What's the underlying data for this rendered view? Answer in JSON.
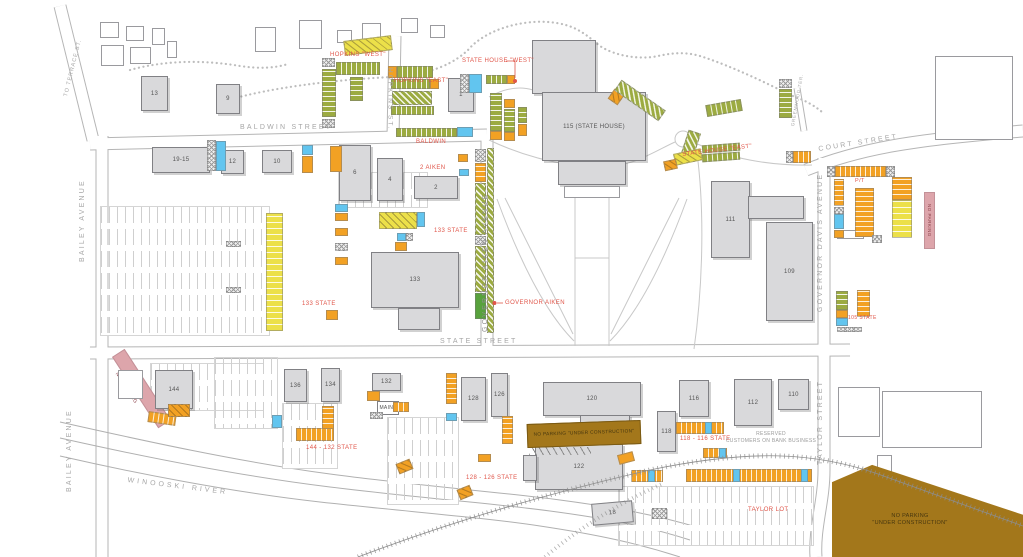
{
  "streets": {
    "to_terrace": "TO TERRACE ST.",
    "hopkins": "HOPKINS ST.",
    "baldwin": "BALDWIN STREET",
    "bailey_upper": "BAILEY AVENUE",
    "bailey_lower": "BAILEY AVENUE",
    "governor_aiken": "GOVERNOR AIKEN AVENUE",
    "state": "STATE STREET",
    "court": "COURT STREET",
    "greenwood": "GREENWOOD TER.",
    "governor_davis": "GOVERNOR DAVIS AVENUE",
    "taylor": "TAYLOR STREET",
    "river": "WINOOSKI RIVER"
  },
  "lot_labels": {
    "hopkins_west": "HOPKINS \"WEST\"",
    "hopkins_east": "HOPKINS \"EAST\"",
    "baldwin": "BALDWIN",
    "state_house_west": "STATE HOUSE \"WEST\"",
    "state_house_east": "STATE HOUSE \"EAST\"",
    "aiken_2": "2 AIKEN",
    "state_133_upper": "133 STATE",
    "state_133_lower": "133 STATE",
    "governor_aiken": "GOVERNOR AIKEN",
    "pt": "P/T",
    "state_105": "105 STATE",
    "state_144_132": "144 - 132 STATE",
    "state_128_126": "128 - 126 STATE",
    "state_118_116": "118 - 116 STATE",
    "taylor_lot": "TAYLOR LOT"
  },
  "zones": {
    "no_parking_bailey": "NO PARKING",
    "no_parking_court": "NO PARKING",
    "construction_strip": "NO PARKING \"UNDER CONSTRUCTION\"",
    "construction_lot_line1": "NO PARKING",
    "construction_lot_line2": "\"UNDER CONSTRUCTION\"",
    "reserved_line1": "RESERVED",
    "reserved_line2": "CUSTOMERS ON BANK BUSINESS"
  },
  "buildings": {
    "b13": "13",
    "b9": "9",
    "b1": "1",
    "b19_15": "19-15",
    "b12": "12",
    "b10": "10",
    "b6": "6",
    "b4": "4",
    "b2": "2",
    "b115": "115 (STATE HOUSE)",
    "b111": "111",
    "b109": "109",
    "b133": "133",
    "b144": "144",
    "b136": "136",
    "b134": "134",
    "b132": "132",
    "bmaint": "MAINT",
    "b128": "128",
    "b126": "126",
    "b120": "120",
    "b122": "122",
    "b118": "118",
    "b116": "116",
    "b112": "112",
    "b110": "110",
    "b18": "18"
  },
  "legend_colors": {
    "permit_green": "#9cab41",
    "meter_yellow": "#ece049",
    "reserved_orange": "#f2a124",
    "accessible_blue": "#62c5ef",
    "no_parking_pink": "#dda5ab",
    "construction_brown": "#a3771b",
    "label_red": "#e0564a"
  }
}
